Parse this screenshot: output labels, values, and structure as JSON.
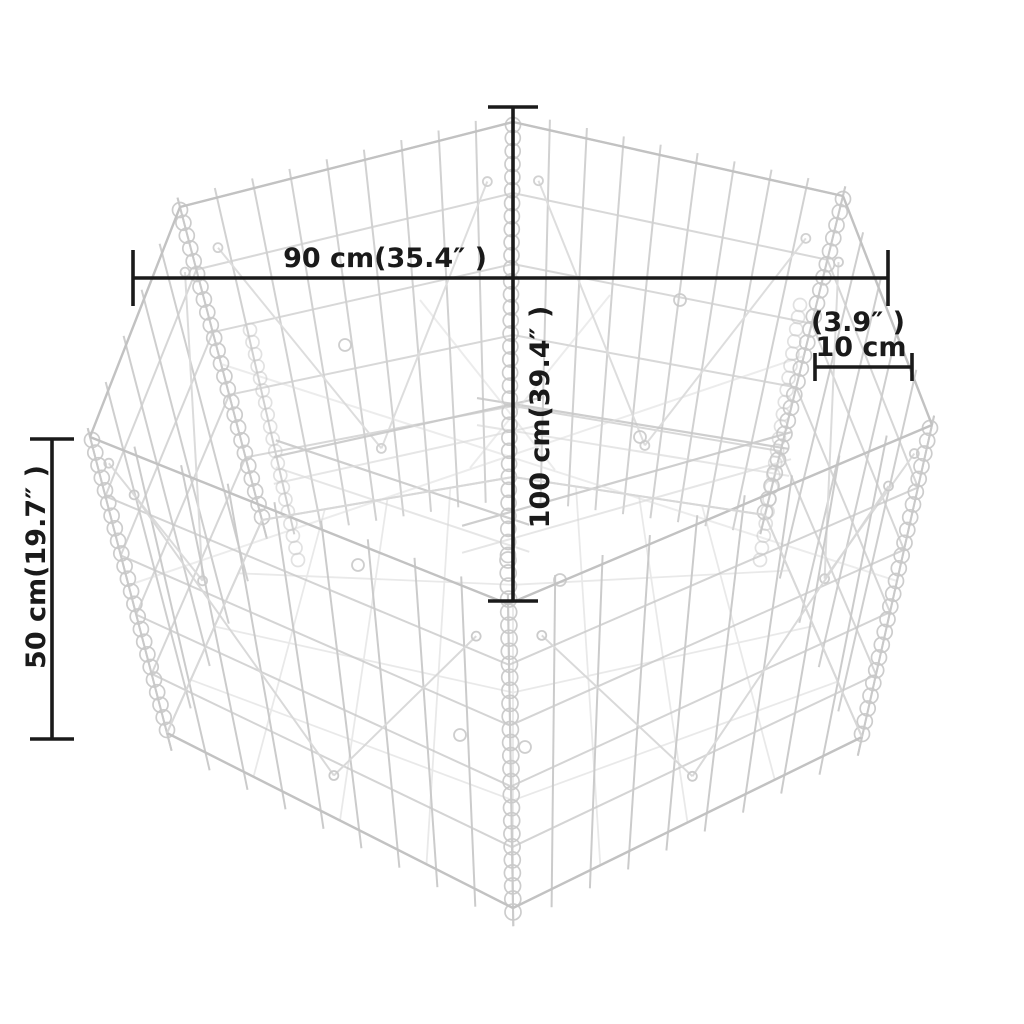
{
  "page": {
    "background": "#ffffff",
    "description": "Dimension diagram of a hexagonal gabion raised-bed wire basket"
  },
  "figure": {
    "type": "product-dimension-diagram",
    "subject": "hexagonal gabion wire-mesh basket",
    "colors": {
      "background": "#ffffff",
      "wire": "#c9c9c9",
      "wire_faint": "#d8d8d8",
      "rim": "#c2c2c2",
      "coil": "#c9c9c9",
      "dimension": "#1a1a1a"
    },
    "measurements": {
      "top_width": {
        "cm": 90,
        "inches": 35.4
      },
      "depth": {
        "cm": 100,
        "inches": 39.4
      },
      "wall_height": {
        "cm": 50,
        "inches": 19.7
      },
      "mesh_cell": {
        "cm": 10,
        "inches": 3.9
      }
    },
    "annotations": [
      {
        "name": "width-90cm",
        "line": [
          133,
          278,
          888,
          278
        ],
        "tick_half": 28,
        "labels": [
          {
            "text": "90 cm(35.4″ )",
            "x": 385,
            "y": 267,
            "rotate": 0
          }
        ]
      },
      {
        "name": "depth-100cm",
        "line": [
          513,
          107,
          513,
          601
        ],
        "tick_half": 25,
        "labels": [
          {
            "text": "100 cm(39.4″ )",
            "x": 549,
            "y": 417,
            "rotate": -90
          }
        ]
      },
      {
        "name": "wall-height-50cm",
        "line": [
          52,
          439,
          52,
          739
        ],
        "tick_half": 22,
        "labels": [
          {
            "text": "50 cm(19.7″ )",
            "x": 45,
            "y": 567,
            "rotate": -90
          }
        ]
      },
      {
        "name": "mesh-cell-10cm",
        "line": [
          815,
          367,
          912,
          367
        ],
        "tick_half": 14,
        "labels": [
          {
            "text": "(3.9″ )",
            "x": 858,
            "y": 331,
            "rotate": 0
          },
          {
            "text": "10 cm",
            "x": 861,
            "y": 356,
            "rotate": 0
          }
        ]
      }
    ]
  }
}
